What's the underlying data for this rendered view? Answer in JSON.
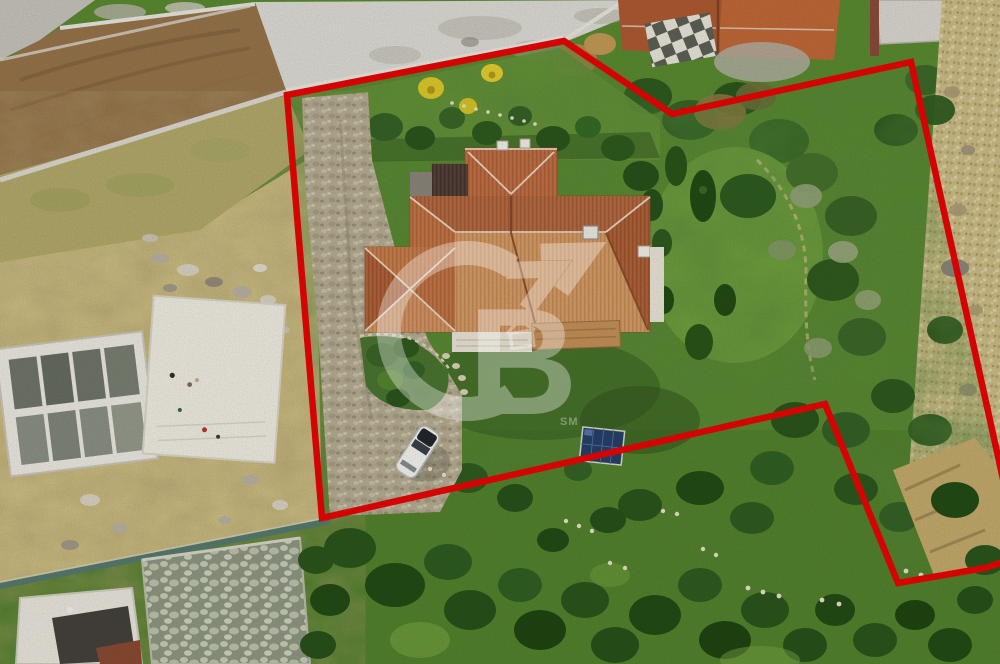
{
  "image": {
    "kind": "aerial drone photograph of a villa plot (real-estate listing photo)",
    "width_px": 1000,
    "height_px": 664
  },
  "annotation": {
    "boundary": {
      "color": "#e70505",
      "stroke_width": 6.5,
      "points": "287,95 564,41 672,114 911,62 1012,520 1015,558 985,568 898,583 825,404 322,518"
    }
  },
  "watermark": {
    "letter": "B",
    "service_mark": "SM",
    "color": "#ffffff",
    "opacity": 0.34
  },
  "palette": {
    "lawn_green": "#5d8c33",
    "dark_tree_green": "#27511a",
    "roof_terracotta": "#c4703f",
    "roof_sunlit": "#d6985f",
    "bare_soil_tan": "#cfc083",
    "dirt_brown": "#96744a",
    "road_concrete": "#dcdbd5",
    "stone_path_tan": "#cbbc86",
    "car_white": "#f2f2ef",
    "solar_panel_blue": "#274066"
  },
  "scene_objects": [
    "villa with terracotta hip roof in centre of plot",
    "red surveyed parcel boundary overlay",
    "cobblestone driveway with parked white car",
    "blue solar panel in garden",
    "lawn, conifers and olive trees inside parcel",
    "neighbouring construction site with bare earth and concrete slab (left)",
    "concrete road and neighbouring tiled roofs (top)",
    "tan stone footpath (right edge)",
    "dense shrub belt along bottom",
    "translucent brokerage watermark logo in centre"
  ]
}
